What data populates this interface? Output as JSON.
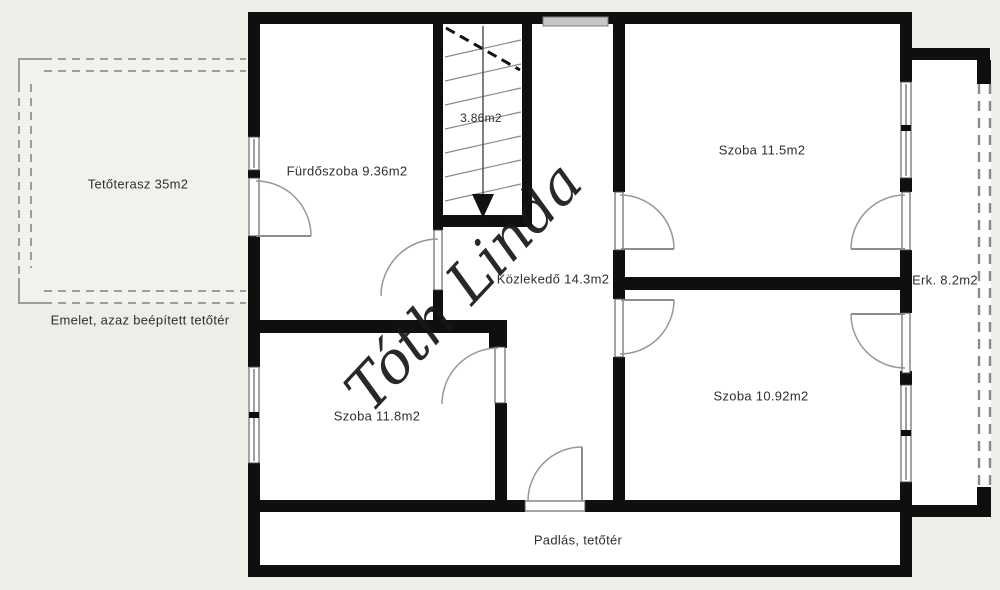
{
  "watermark": "Tóth Linda",
  "labels": {
    "terrace": "Tetőterasz 35m2",
    "floor_note": "Emelet, azaz beépített tetőtér",
    "bathroom": "Fürdőszoba 9.36m2",
    "stairwell": "3.86m2",
    "room_top_right": "Szoba 11.5m2",
    "hallway": "Közlekedő 14.3m2",
    "balcony": "Erk. 8.2m2",
    "room_bottom_right": "Szoba 10.92m2",
    "room_bottom_left": "Szoba 11.8m2",
    "attic": "Padlás, tetőtér"
  },
  "colors": {
    "background": "#efede7",
    "floor": "#ffffff",
    "wall": "#0f0f0f",
    "window_fill": "#c6c6c6",
    "door_arc": "#979797",
    "dashed_line": "#9d9d9d",
    "text": "#2f2f2f",
    "watermark": "#161616"
  }
}
